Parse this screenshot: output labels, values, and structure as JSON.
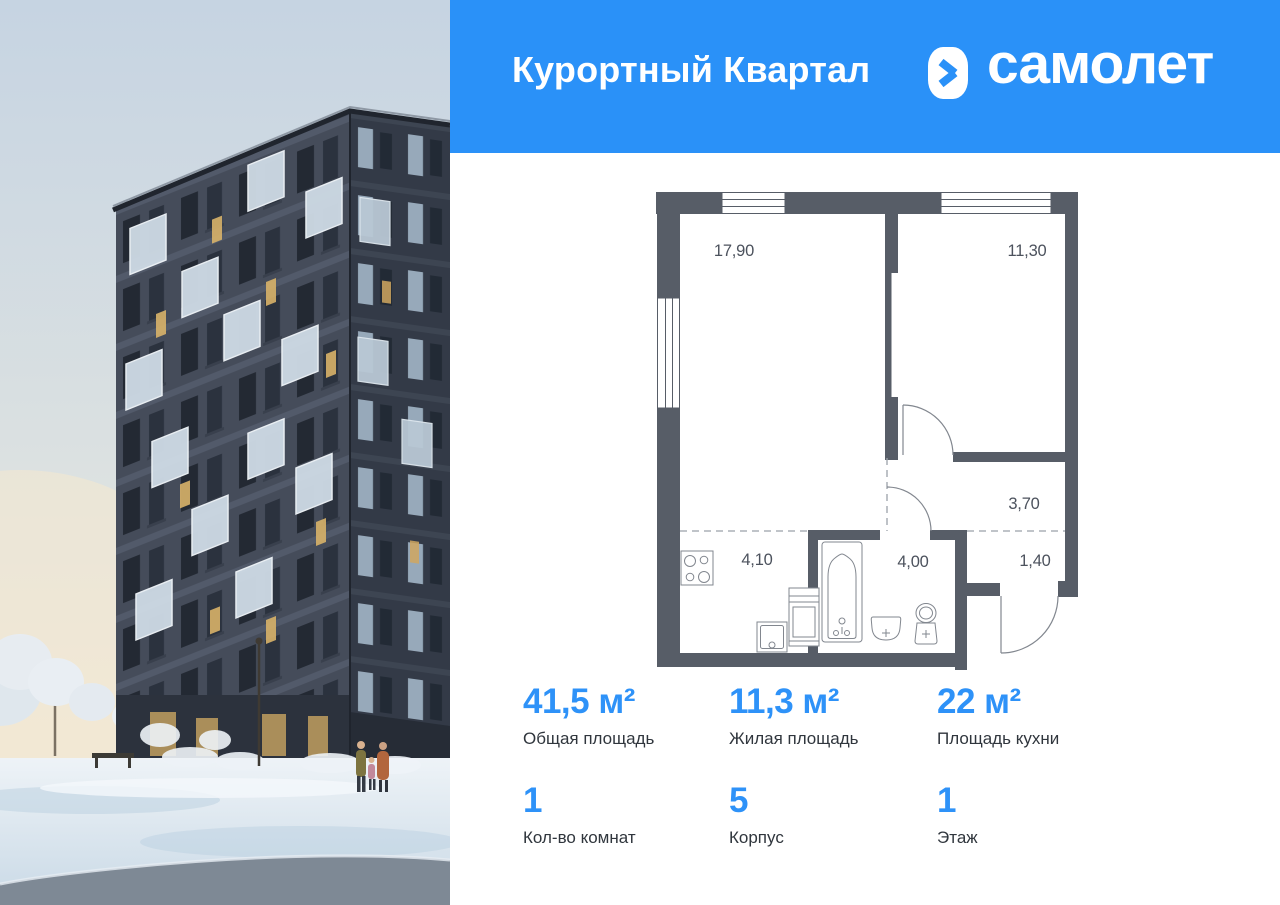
{
  "header": {
    "title": "Курортный Квартал",
    "brand": "самолет"
  },
  "floor_plan": {
    "rooms": [
      {
        "id": "living-room",
        "area": "17,90"
      },
      {
        "id": "bedroom",
        "area": "11,30"
      },
      {
        "id": "hallway",
        "area": "3,70"
      },
      {
        "id": "entry",
        "area": "1,40"
      },
      {
        "id": "kitchen",
        "area": "4,10"
      },
      {
        "id": "bathroom",
        "area": "4,00"
      }
    ],
    "fixtures": [
      "stove-icon",
      "kitchen-sink-icon",
      "washing-machine-icon",
      "bathtub-icon",
      "washbasin-icon",
      "toilet-icon"
    ]
  },
  "stats": [
    {
      "value": "41,5 м²",
      "label": "Общая площадь"
    },
    {
      "value": "11,3 м²",
      "label": "Жилая площадь"
    },
    {
      "value": "22 м²",
      "label": "Площадь кухни"
    },
    {
      "value": "1",
      "label": "Кол-во комнат"
    },
    {
      "value": "5",
      "label": "Корпус"
    },
    {
      "value": "1",
      "label": "Этаж"
    }
  ],
  "colors": {
    "accent_blue": "#2A91F8",
    "stat_number_blue": "#2E92F8",
    "plan_wall": "#575D67",
    "plan_line": "#82878F"
  }
}
